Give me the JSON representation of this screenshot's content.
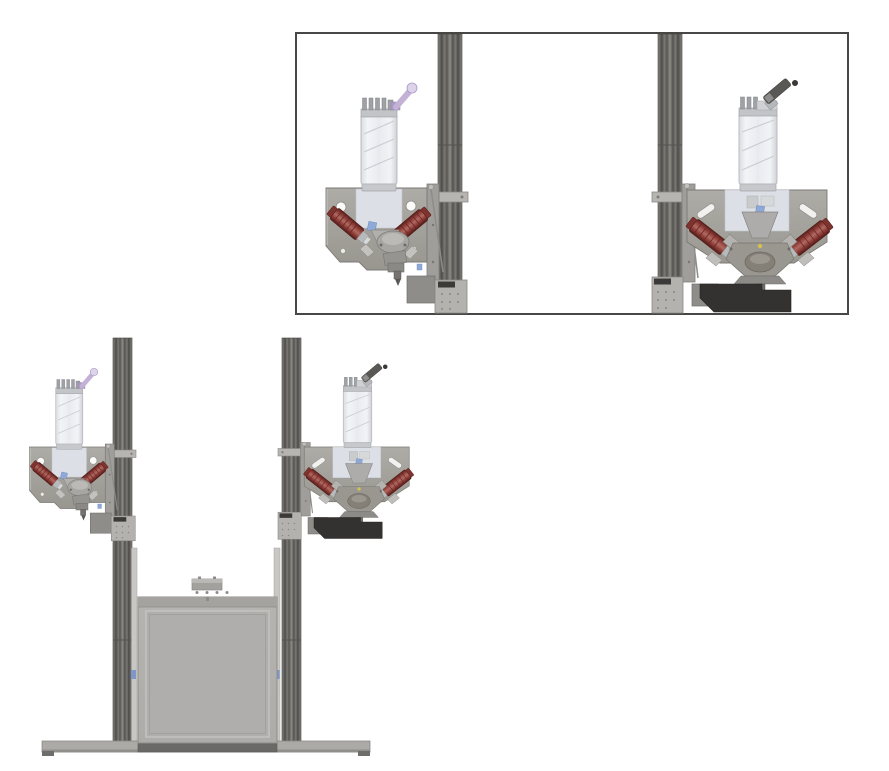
{
  "figure": {
    "title": "CAD rendering of a dual syringe-extruder gantry machine",
    "background_color": "#ffffff",
    "main_view_label": "Full machine front view with two vertical rails, two extruder heads, build chamber and base plate",
    "inset_label": "Detail view of the left and right syringe extruder heads"
  },
  "inset": {
    "border_color": "#474745",
    "fill_color": "#ffffff"
  },
  "components": {
    "rail_left": {
      "label": "left vertical linear rail",
      "color": "#6e6c68"
    },
    "rail_right": {
      "label": "right vertical linear rail",
      "color": "#6e6c68"
    },
    "extruder_left": {
      "label": "left syringe extruder head assembly"
    },
    "extruder_right": {
      "label": "right syringe extruder head assembly"
    },
    "mount_plate": {
      "label": "extruder mounting plate",
      "color": "#a5a39d"
    },
    "cartridge": {
      "label": "transparent syringe cartridge with auger",
      "color": "#eff1f4"
    },
    "cartridge_cap": {
      "label": "cartridge cap with pins",
      "color": "#c2c4c8"
    },
    "luer_fitting": {
      "label": "purple luer fitting and cap",
      "color": "#c3b1d6"
    },
    "handle": {
      "label": "dark angled cartridge handle",
      "color": "#5a5855"
    },
    "motor": {
      "label": "angled drive motor",
      "color": "#8b3a35"
    },
    "funnel": {
      "label": "material funnel and mixing chamber",
      "color": "#aeacaa"
    },
    "carriage": {
      "label": "rail carriage plate",
      "color": "#b4b2ae"
    },
    "carriage_label": {
      "label": "small dark identification sticker",
      "color": "#3c3a38"
    },
    "sensor_bracket": {
      "label": "black lower bracket",
      "color": "#343230"
    },
    "build_chamber": {
      "label": "build chamber box",
      "color": "#b3b1ad"
    },
    "chamber_connector": {
      "label": "connector block on chamber top",
      "color": "#a3a19d"
    },
    "base_plate": {
      "label": "machine base plate",
      "color": "#acaaa6"
    },
    "lift_strip": {
      "label": "thin vertical lift strip",
      "color": "#c9c7c3"
    },
    "blue_clip": {
      "label": "small blue clip",
      "color": "#7d97c8"
    }
  }
}
